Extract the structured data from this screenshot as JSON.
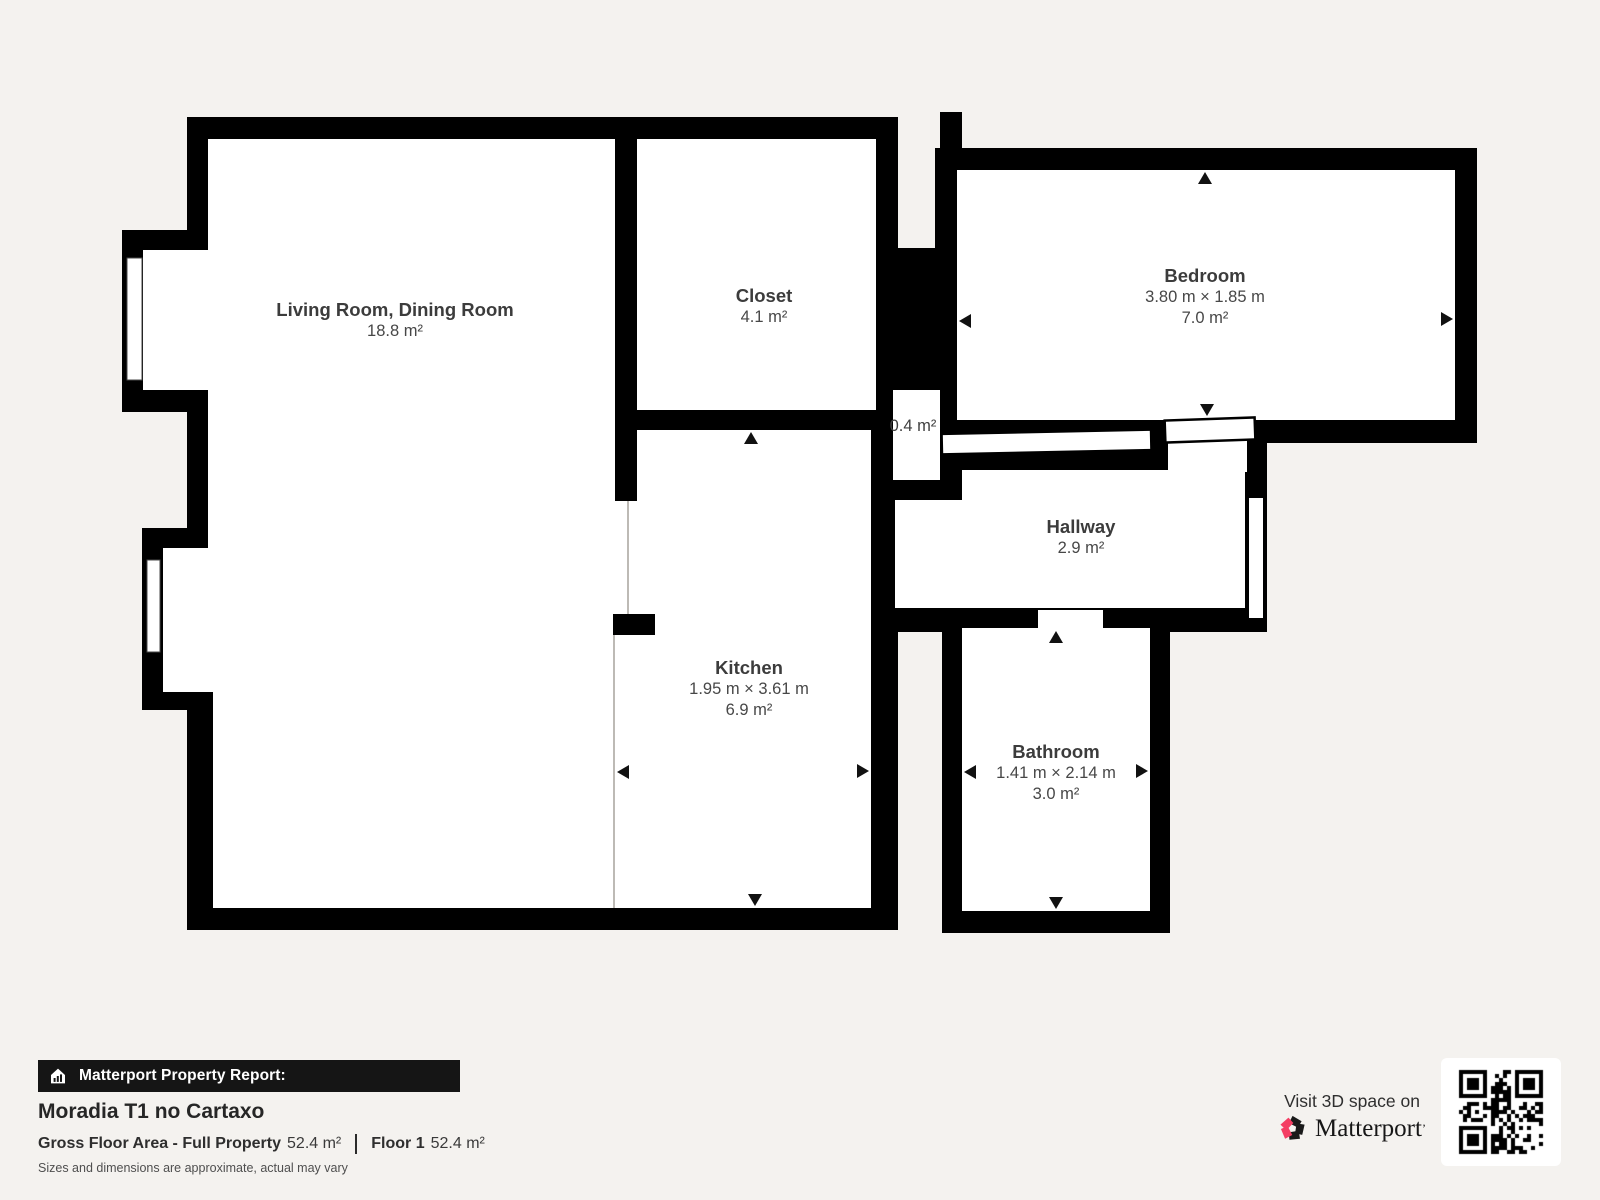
{
  "page": {
    "background_color": "#f4f2ef",
    "wall_color": "#000000",
    "accent_pink": "#f43e63"
  },
  "floorplan": {
    "rooms": [
      {
        "name": "Living Room, Dining Room",
        "dims": "",
        "area": "18.8 m²"
      },
      {
        "name": "Closet",
        "dims": "",
        "area": "4.1 m²"
      },
      {
        "name": "Bedroom",
        "dims": "3.80 m × 1.85 m",
        "area": "7.0 m²"
      },
      {
        "name": "",
        "dims": "",
        "area": "0.4 m²"
      },
      {
        "name": "Hallway",
        "dims": "",
        "area": "2.9 m²"
      },
      {
        "name": "Kitchen",
        "dims": "1.95 m × 3.61 m",
        "area": "6.9 m²"
      },
      {
        "name": "Bathroom",
        "dims": "1.41 m × 2.14 m",
        "area": "3.0 m²"
      }
    ],
    "icons": {
      "dimension_arrows": "small black triangles marking measured spans",
      "windows": "white slots in exterior walls",
      "door": "open door leaf at bedroom entrance"
    }
  },
  "report": {
    "brand_bar": "Matterport Property Report:",
    "property_name": "Moradia T1 no Cartaxo",
    "gross_area_label": "Gross Floor Area - Full Property",
    "gross_area_value": "52.4 m²",
    "floor_label": "Floor 1",
    "floor_value": "52.4 m²",
    "disclaimer": "Sizes and dimensions are approximate, actual may vary"
  },
  "cta": {
    "visit_text": "Visit 3D space on",
    "brand_name": "Matterport",
    "brand_mark": "’"
  }
}
